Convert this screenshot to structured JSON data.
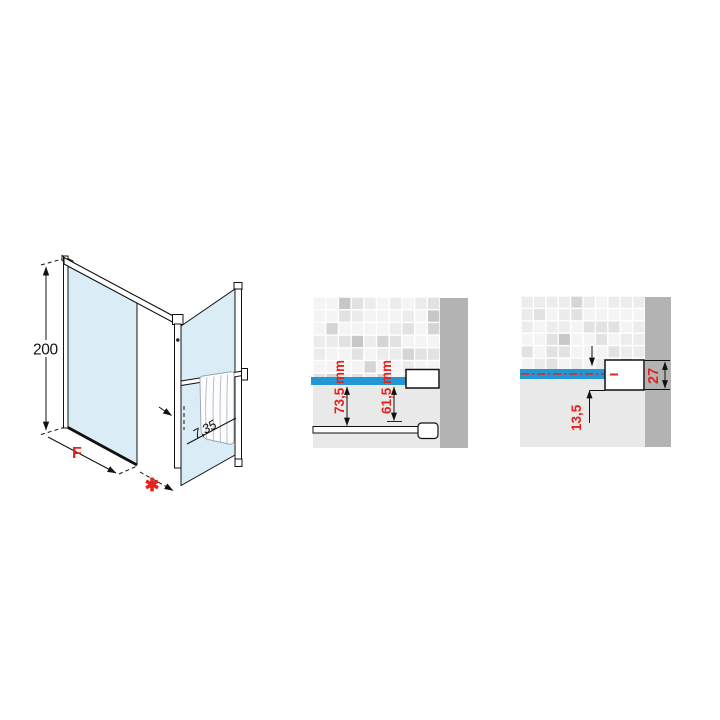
{
  "canvas": {
    "background": "#ffffff"
  },
  "palette": {
    "accent_red": "#e5231c",
    "glass_blue": "#daedf6",
    "highlight_blue": "#2397d3",
    "wall_gray": "#b3b3b3",
    "floor_gray": "#e9e9e9",
    "line_black": "#111111",
    "tile_shades": [
      "#f4f4f4",
      "#ececec",
      "#e2e2e2",
      "#d5d5d5",
      "#c7c7c7"
    ]
  },
  "iso_view": {
    "height_dim": "200",
    "width_dim": "F",
    "extension_marker": "✱",
    "depth_dim": "7,35"
  },
  "wall_fixing_detail": {
    "dim_glass_to_wall": "73,5 mm",
    "dim_profile_to_wall": "61,5 mm"
  },
  "profile_detail": {
    "dim_offset": "13,5",
    "dim_profile_width": "27"
  }
}
